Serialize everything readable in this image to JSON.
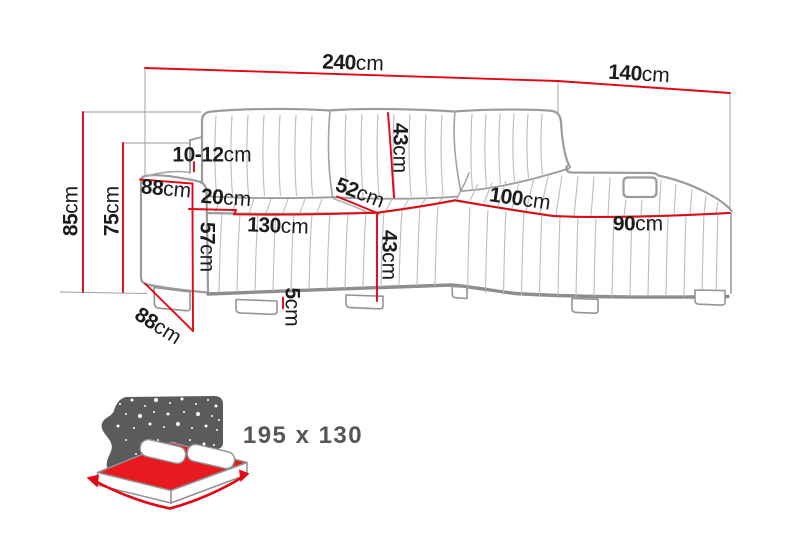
{
  "diagram_title": "corner-sofa-dimension-drawing",
  "colors": {
    "dimension_line_red": "#e30613",
    "sofa_outline_gray": "#9b9b9b",
    "icon_gray": "#595b5d",
    "mattress_red": "#e8191f",
    "label_black": "#1c1c1c"
  },
  "labels": [
    {
      "id": "overall-width",
      "num": "240",
      "unit": "cm"
    },
    {
      "id": "chaise-depth",
      "num": "140",
      "unit": "cm"
    },
    {
      "id": "total-height",
      "num": "85",
      "unit": "cm"
    },
    {
      "id": "armrest-height-outer",
      "num": "75",
      "unit": "cm"
    },
    {
      "id": "back-gap",
      "num": "10-12",
      "unit": "cm"
    },
    {
      "id": "armrest-depth",
      "num": "88",
      "unit": "cm"
    },
    {
      "id": "armrest-width",
      "num": "20",
      "unit": "cm"
    },
    {
      "id": "armrest-front-height",
      "num": "57",
      "unit": "cm"
    },
    {
      "id": "left-seat-width",
      "num": "130",
      "unit": "cm"
    },
    {
      "id": "backrest-height",
      "num": "43",
      "unit": "cm"
    },
    {
      "id": "seat-depth",
      "num": "52",
      "unit": "cm"
    },
    {
      "id": "seat-height",
      "num": "43",
      "unit": "cm"
    },
    {
      "id": "chaise-width-back",
      "num": "100",
      "unit": "cm"
    },
    {
      "id": "chaise-width-front",
      "num": "90",
      "unit": "cm"
    },
    {
      "id": "leg-height",
      "num": "5",
      "unit": "cm"
    },
    {
      "id": "base-depth",
      "num": "88",
      "unit": "cm"
    }
  ],
  "bed_function": {
    "size_label": "195 x 130"
  }
}
